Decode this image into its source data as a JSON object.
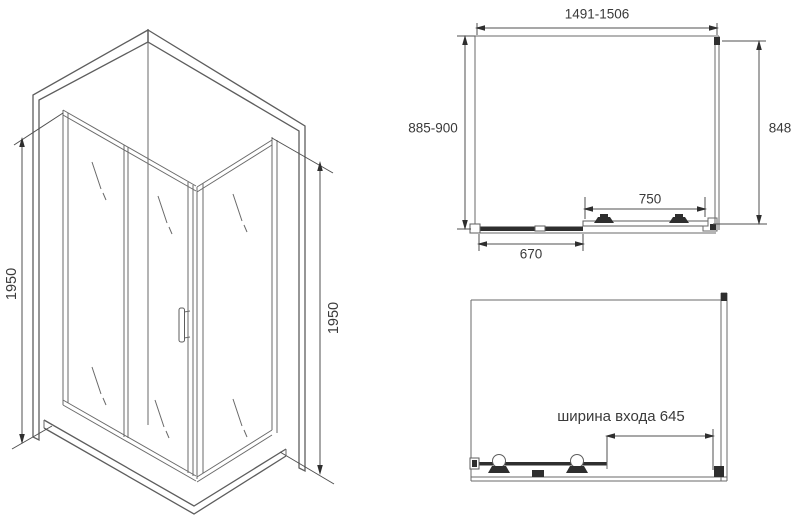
{
  "title": "Shower enclosure technical drawing",
  "colors": {
    "background": "#ffffff",
    "line": "#6a6a6a",
    "dark_detail": "#2e2e2e",
    "text": "#3a3a3a"
  },
  "isometric_view": {
    "height_left": "1950",
    "height_right": "1950"
  },
  "plan_view": {
    "width_range": "1491-1506",
    "depth_range": "885-900",
    "side_panel_depth": "848",
    "door_width": "750",
    "fixed_panel_width": "670"
  },
  "front_view": {
    "entrance_width_label": "ширина входа 645"
  }
}
